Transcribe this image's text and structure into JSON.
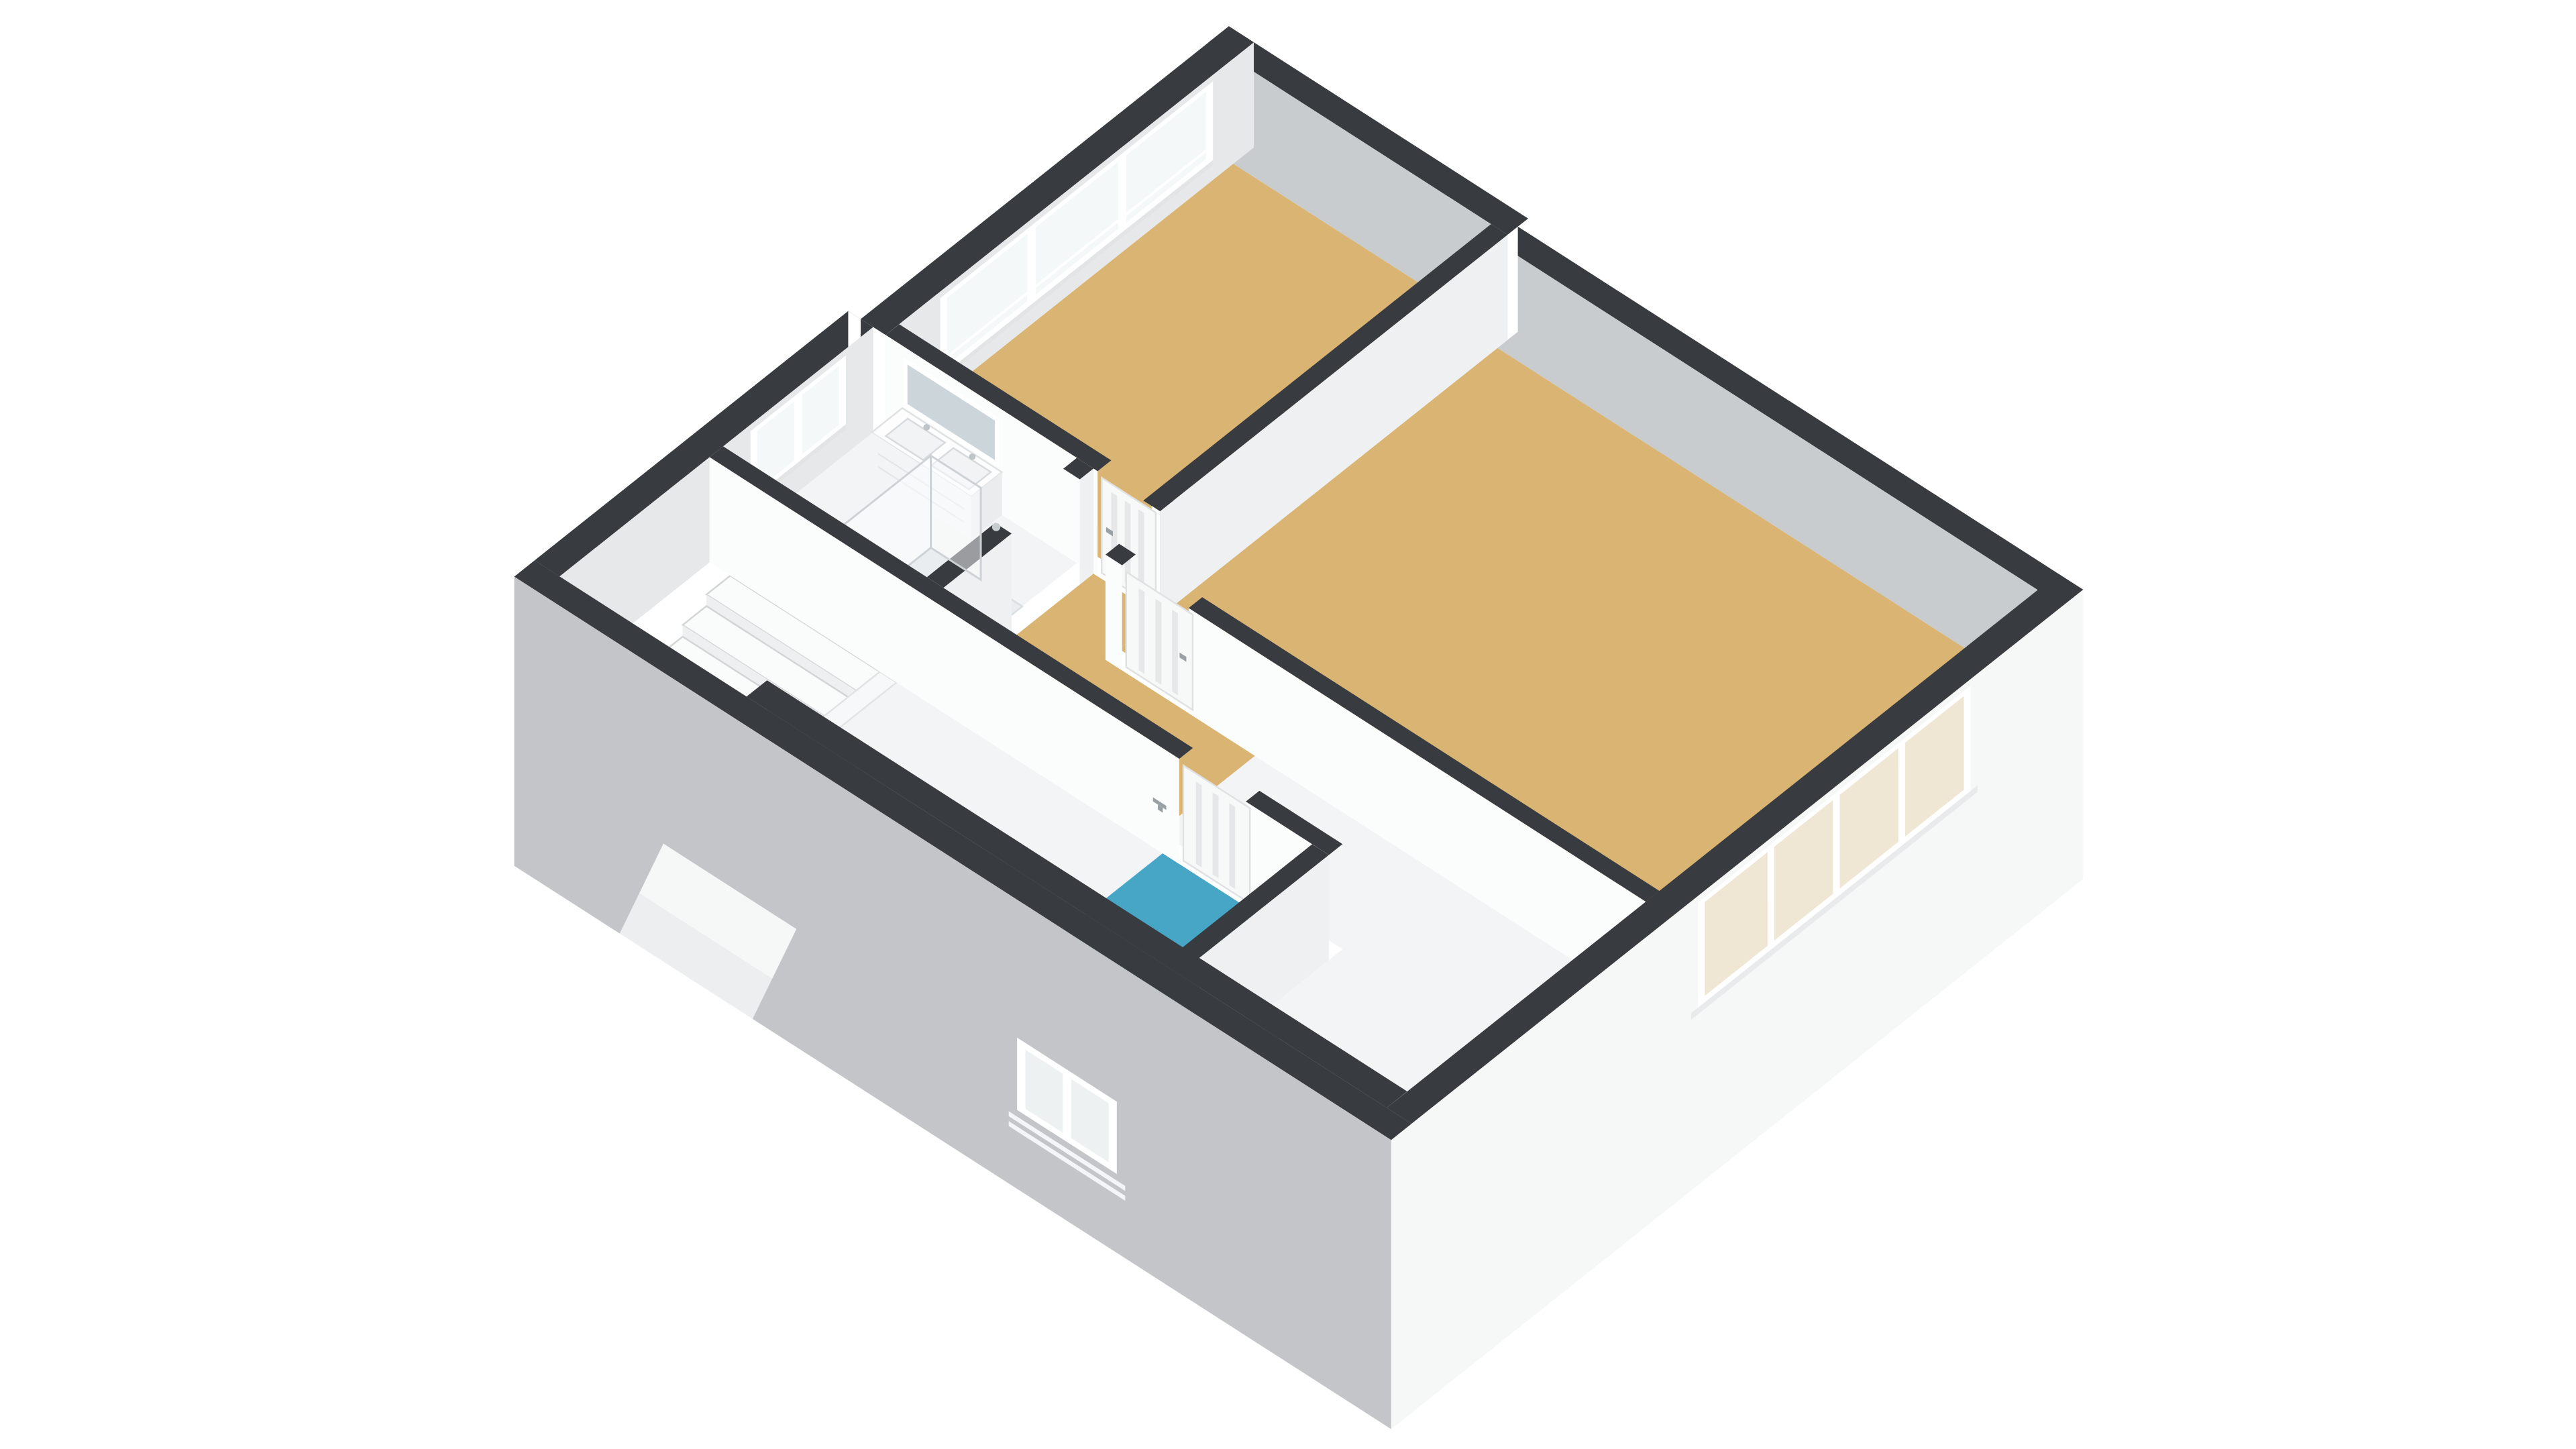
{
  "app": {
    "name": "3d-floor-plan-view",
    "description": "Isometric 3D floor plan of an upper storey, no visible text labels"
  },
  "colors": {
    "background": "#ffffff",
    "band": "#383b40",
    "facadeWhite": "#f6f7f7",
    "facadeGray": "#c3c5c8",
    "innerGray": "#c9cccf",
    "innerLight": "#e7e8ea",
    "faceWhite": "#fbfcfc",
    "faceSoft": "#eef0f1",
    "wood": "#d9b472",
    "floorWhite": "#f3f4f5",
    "wc": "#47a5c6",
    "shower": "#e9edef",
    "glass": "#f5f8f9",
    "mirror": "#ccd6da",
    "tread": "#fafbfb",
    "treadEdge": "#d2d4d6",
    "riser": "#edeff1",
    "leaf": "#f7f8f8",
    "slat": "#e6e7e9",
    "handle": "#9aa1a6",
    "seGlass": "#efe6d3",
    "sill": "#e3e4e6",
    "wellFloor": "#e8eaeb",
    "stringer": "#f7f8f9"
  },
  "rooms": [
    {
      "id": "bedroom-top",
      "floor": "wood",
      "features": [
        "three-pane-window-band",
        "door-to-landing"
      ]
    },
    {
      "id": "bedroom-right",
      "floor": "wood",
      "features": [
        "four-pane-window-band",
        "door-to-landing"
      ]
    },
    {
      "id": "bathroom",
      "floor": "white",
      "features": [
        "double-vanity",
        "mirror",
        "walk-in-shower",
        "two-pane-window"
      ]
    },
    {
      "id": "hall-landing",
      "floor": "wood-and-white",
      "features": [
        "winder-staircase",
        "stairs-continue-below"
      ]
    },
    {
      "id": "wc",
      "floor": "blue",
      "features": [
        "door-with-handle",
        "small-exterior-window"
      ]
    }
  ],
  "fixtures": [
    "winder-staircase",
    "ghost-stairs-below-facade",
    "double-vanity-with-basins-and-faucets",
    "wall-mirror",
    "shower-glass-panels",
    "shower-head",
    "door-leaves-with-handles",
    "window-frames-with-mullions"
  ]
}
